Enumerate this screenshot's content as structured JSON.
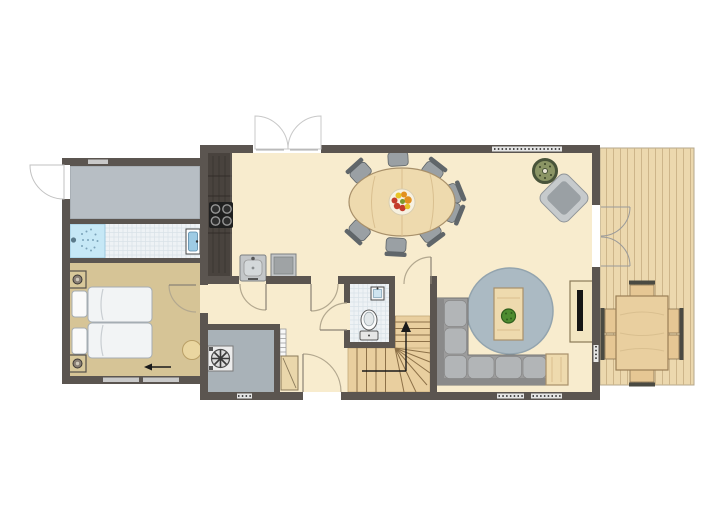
{
  "title": "Holiday home floor plan, ground floor with deck",
  "colors": {
    "wall": "#5b5550",
    "floorMain": "#f8ecce",
    "floorBedroom": "#d6c496",
    "floorEntry": "#b7bec4",
    "floorUtility": "#a9b2b8",
    "tile": "#eef2f5",
    "tileLine": "#d9e2e7",
    "shower": "#c6e8f6",
    "rug": "#abbac3",
    "wood": "#eedaae",
    "woodLine": "#d9bf8f",
    "woodStroke": "#a8906a",
    "counter": "#49433e",
    "counterLine": "#322d29",
    "deck": "#ecd8ae",
    "deckLine": "#cdb58a",
    "chair": "#9aa0a4",
    "chairBack": "#60666a",
    "chairStroke": "#5d6367",
    "sofa": "#9c9c9c",
    "cushion": "#b2b5b7",
    "sofaStroke": "#737373",
    "mattress": "#f2f4f5",
    "mattressStroke": "#a5adb3",
    "stairs": "#e9cf9f",
    "stairLine": "#8d7148",
    "plantDark": "#49543a",
    "plantMid": "#8b9565",
    "potPlant": "#4e8c30",
    "sinkBlue": "#9ecbe4",
    "doorArc": "#b3a88f",
    "windowBar": "#c9c9c9",
    "white": "#ffffff",
    "black": "#1a1a1a",
    "fruitRed": "#c43b2a",
    "fruitOrange": "#e2901e",
    "fruitYellow": "#e7c327",
    "fruitGreen": "#7d9a2e"
  },
  "counts": {
    "dining_chairs": 8,
    "deck_chairs": 6,
    "beds": 2,
    "plants": 2
  },
  "depicted_items": [
    "entry-hall",
    "bathroom-shower",
    "washbasin",
    "double-bed",
    "nightstand-lamps",
    "pouf",
    "kitchen-counter",
    "stove",
    "kitchen-sink",
    "oven",
    "oval-dining-table",
    "fruit-bowl",
    "dining-chairs",
    "potted-plant",
    "armchair",
    "round-rug",
    "coffee-table",
    "corner-sofa",
    "side-table",
    "tv-sideboard",
    "wc-toilet",
    "wc-sink",
    "winder-staircase",
    "utility-room",
    "washing-machine",
    "storage-shelf",
    "cupboard",
    "wood-deck",
    "deck-table",
    "deck-chairs"
  ]
}
